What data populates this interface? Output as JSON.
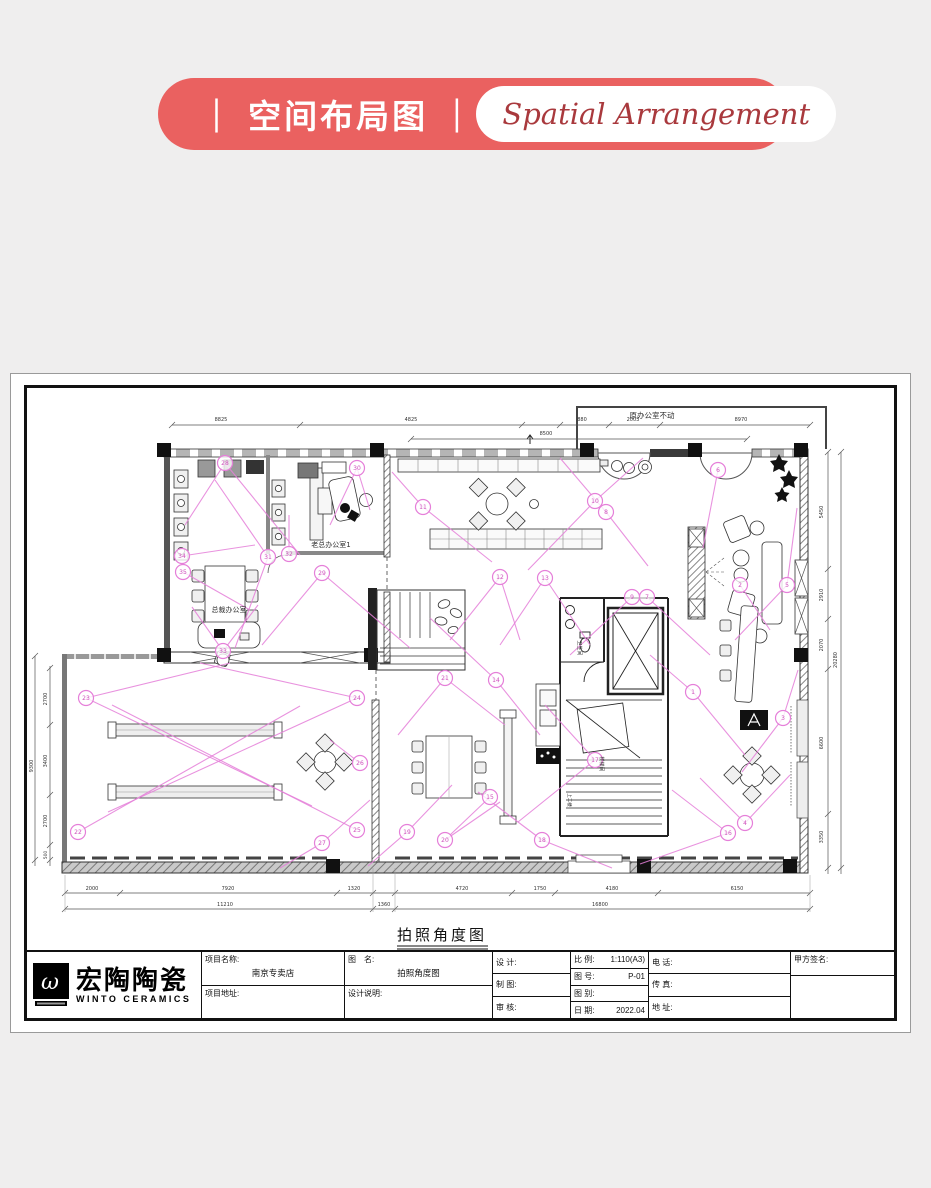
{
  "banner": {
    "title": "｜ 空间布局图 ｜",
    "subtitle": "Spatial Arrangement",
    "bg_color": "#ea6160",
    "subtitle_color": "#a9393d"
  },
  "logo": {
    "cn": "宏陶陶瓷",
    "en": "WINTO CERAMICS",
    "mark": "ω"
  },
  "plan": {
    "caption": "拍照角度图",
    "accent_color": "#e57fd9",
    "annotations": [
      {
        "t": "老总办公室1",
        "x": 331,
        "y": 547,
        "s": 7
      },
      {
        "t": "总裁办公室",
        "x": 229,
        "y": 612,
        "s": 7
      },
      {
        "t": "原办公室不动",
        "x": 652,
        "y": 418,
        "s": 7.5
      },
      {
        "t": "卫生间",
        "x": 578,
        "y": 648,
        "s": 5,
        "r": 90
      },
      {
        "t": "楼梯间",
        "x": 600,
        "y": 764,
        "s": 5,
        "r": 90
      },
      {
        "t": "上二楼",
        "x": 568,
        "y": 800,
        "s": 4.5,
        "r": 90
      },
      {
        "t": "8825",
        "x": 221,
        "y": 421,
        "s": 5
      },
      {
        "t": "4825",
        "x": 411,
        "y": 421,
        "s": 5
      },
      {
        "t": "880",
        "x": 582,
        "y": 421,
        "s": 5
      },
      {
        "t": "2003",
        "x": 633,
        "y": 421,
        "s": 5
      },
      {
        "t": "8970",
        "x": 741,
        "y": 421,
        "s": 5
      },
      {
        "t": "8500",
        "x": 546,
        "y": 435,
        "s": 5
      },
      {
        "t": "2700",
        "x": 47,
        "y": 699,
        "s": 5,
        "r": -90
      },
      {
        "t": "3400",
        "x": 47,
        "y": 761,
        "s": 5,
        "r": -90
      },
      {
        "t": "2700",
        "x": 47,
        "y": 821,
        "s": 5,
        "r": -90
      },
      {
        "t": "500",
        "x": 47,
        "y": 855,
        "s": 4.5,
        "r": -90
      },
      {
        "t": "9300",
        "x": 33,
        "y": 766,
        "s": 5,
        "r": -90
      },
      {
        "t": "5450",
        "x": 823,
        "y": 512,
        "s": 5,
        "r": -90
      },
      {
        "t": "2910",
        "x": 823,
        "y": 595,
        "s": 5,
        "r": -90
      },
      {
        "t": "2070",
        "x": 823,
        "y": 645,
        "s": 5,
        "r": -90
      },
      {
        "t": "6600",
        "x": 823,
        "y": 743,
        "s": 5,
        "r": -90
      },
      {
        "t": "3350",
        "x": 823,
        "y": 837,
        "s": 5,
        "r": -90
      },
      {
        "t": "20280",
        "x": 837,
        "y": 660,
        "s": 5,
        "r": -90
      },
      {
        "t": "2000",
        "x": 92,
        "y": 890,
        "s": 5
      },
      {
        "t": "7920",
        "x": 228,
        "y": 890,
        "s": 5
      },
      {
        "t": "1320",
        "x": 354,
        "y": 890,
        "s": 5
      },
      {
        "t": "4720",
        "x": 462,
        "y": 890,
        "s": 5
      },
      {
        "t": "1750",
        "x": 540,
        "y": 890,
        "s": 5
      },
      {
        "t": "4180",
        "x": 612,
        "y": 890,
        "s": 5
      },
      {
        "t": "6150",
        "x": 737,
        "y": 890,
        "s": 5
      },
      {
        "t": "11210",
        "x": 225,
        "y": 906,
        "s": 5
      },
      {
        "t": "1360",
        "x": 384,
        "y": 906,
        "s": 5
      },
      {
        "t": "16800",
        "x": 600,
        "y": 906,
        "s": 5
      }
    ],
    "cameras": [
      {
        "n": "1",
        "x": 693,
        "y": 692
      },
      {
        "n": "2",
        "x": 740,
        "y": 585
      },
      {
        "n": "3",
        "x": 783,
        "y": 718
      },
      {
        "n": "4",
        "x": 745,
        "y": 823
      },
      {
        "n": "5",
        "x": 787,
        "y": 585
      },
      {
        "n": "6",
        "x": 718,
        "y": 470
      },
      {
        "n": "7",
        "x": 647,
        "y": 597
      },
      {
        "n": "8",
        "x": 606,
        "y": 512
      },
      {
        "n": "9",
        "x": 632,
        "y": 597
      },
      {
        "n": "10",
        "x": 595,
        "y": 501
      },
      {
        "n": "11",
        "x": 423,
        "y": 507
      },
      {
        "n": "12",
        "x": 500,
        "y": 577
      },
      {
        "n": "13",
        "x": 545,
        "y": 578
      },
      {
        "n": "14",
        "x": 496,
        "y": 680
      },
      {
        "n": "15",
        "x": 490,
        "y": 797
      },
      {
        "n": "16",
        "x": 728,
        "y": 833
      },
      {
        "n": "17",
        "x": 595,
        "y": 760
      },
      {
        "n": "18",
        "x": 542,
        "y": 840
      },
      {
        "n": "19",
        "x": 407,
        "y": 832
      },
      {
        "n": "20",
        "x": 445,
        "y": 840
      },
      {
        "n": "21",
        "x": 445,
        "y": 678
      },
      {
        "n": "22",
        "x": 78,
        "y": 832
      },
      {
        "n": "23",
        "x": 86,
        "y": 698
      },
      {
        "n": "24",
        "x": 357,
        "y": 698
      },
      {
        "n": "25",
        "x": 357,
        "y": 830
      },
      {
        "n": "26",
        "x": 360,
        "y": 763
      },
      {
        "n": "27",
        "x": 322,
        "y": 843
      },
      {
        "n": "28",
        "x": 225,
        "y": 463
      },
      {
        "n": "29",
        "x": 322,
        "y": 573
      },
      {
        "n": "30",
        "x": 357,
        "y": 468
      },
      {
        "n": "31",
        "x": 268,
        "y": 557
      },
      {
        "n": "32",
        "x": 289,
        "y": 554
      },
      {
        "n": "33",
        "x": 223,
        "y": 651
      },
      {
        "n": "34",
        "x": 182,
        "y": 556
      },
      {
        "n": "35",
        "x": 183,
        "y": 572
      }
    ],
    "sightlines": [
      [
        225,
        463,
        300,
        555
      ],
      [
        225,
        463,
        185,
        525
      ],
      [
        357,
        468,
        330,
        525
      ],
      [
        357,
        468,
        370,
        510
      ],
      [
        182,
        556,
        255,
        545
      ],
      [
        183,
        572,
        250,
        610
      ],
      [
        268,
        557,
        215,
        480
      ],
      [
        268,
        557,
        235,
        648
      ],
      [
        289,
        554,
        289,
        515
      ],
      [
        322,
        573,
        262,
        645
      ],
      [
        322,
        573,
        410,
        648
      ],
      [
        223,
        651,
        258,
        605
      ],
      [
        223,
        651,
        192,
        607
      ],
      [
        423,
        507,
        392,
        472
      ],
      [
        423,
        507,
        492,
        562
      ],
      [
        595,
        501,
        643,
        458
      ],
      [
        595,
        501,
        528,
        570
      ],
      [
        606,
        512,
        560,
        458
      ],
      [
        606,
        512,
        648,
        566
      ],
      [
        632,
        597,
        570,
        655
      ],
      [
        647,
        597,
        710,
        655
      ],
      [
        500,
        577,
        450,
        640
      ],
      [
        500,
        577,
        520,
        640
      ],
      [
        545,
        578,
        500,
        645
      ],
      [
        545,
        578,
        590,
        645
      ],
      [
        718,
        470,
        703,
        548
      ],
      [
        787,
        585,
        797,
        508
      ],
      [
        787,
        585,
        735,
        640
      ],
      [
        740,
        585,
        770,
        630
      ],
      [
        693,
        692,
        650,
        655
      ],
      [
        693,
        692,
        745,
        755
      ],
      [
        783,
        718,
        742,
        772
      ],
      [
        783,
        718,
        798,
        670
      ],
      [
        745,
        823,
        700,
        778
      ],
      [
        745,
        823,
        790,
        775
      ],
      [
        728,
        833,
        672,
        790
      ],
      [
        728,
        833,
        640,
        864
      ],
      [
        496,
        680,
        540,
        735
      ],
      [
        496,
        680,
        430,
        618
      ],
      [
        445,
        678,
        398,
        735
      ],
      [
        445,
        678,
        505,
        725
      ],
      [
        595,
        760,
        545,
        705
      ],
      [
        595,
        760,
        518,
        822
      ],
      [
        490,
        797,
        450,
        835
      ],
      [
        542,
        840,
        478,
        792
      ],
      [
        542,
        840,
        612,
        868
      ],
      [
        407,
        832,
        452,
        785
      ],
      [
        407,
        832,
        368,
        866
      ],
      [
        445,
        840,
        500,
        802
      ],
      [
        86,
        698,
        312,
        806
      ],
      [
        357,
        698,
        108,
        812
      ],
      [
        78,
        832,
        300,
        706
      ],
      [
        357,
        830,
        112,
        705
      ],
      [
        86,
        698,
        230,
        663
      ],
      [
        357,
        698,
        200,
        663
      ],
      [
        360,
        763,
        330,
        740
      ],
      [
        322,
        843,
        280,
        868
      ],
      [
        322,
        843,
        370,
        800
      ]
    ]
  },
  "titleblock": {
    "project_name_label": "项目名称:",
    "project_name": "南京专卖店",
    "project_addr_label": "项目地址:",
    "drawing_name_label": "图　名:",
    "drawing_name": "拍照角度图",
    "design_note_label": "设计说明:",
    "design_label": "设 计:",
    "draft_label": "制 图:",
    "review_label": "审 核:",
    "scale_label": "比 例:",
    "scale_value": "1:110(A3)",
    "no_label": "图 号:",
    "no_value": "P-01",
    "type_label": "图 别:",
    "type_value": "",
    "date_label": "日 期:",
    "date_value": "2022.04",
    "tel_label": "电 话:",
    "fax_label": "传 真:",
    "addr_label": "地 址:",
    "sign_label": "甲方签名:"
  }
}
